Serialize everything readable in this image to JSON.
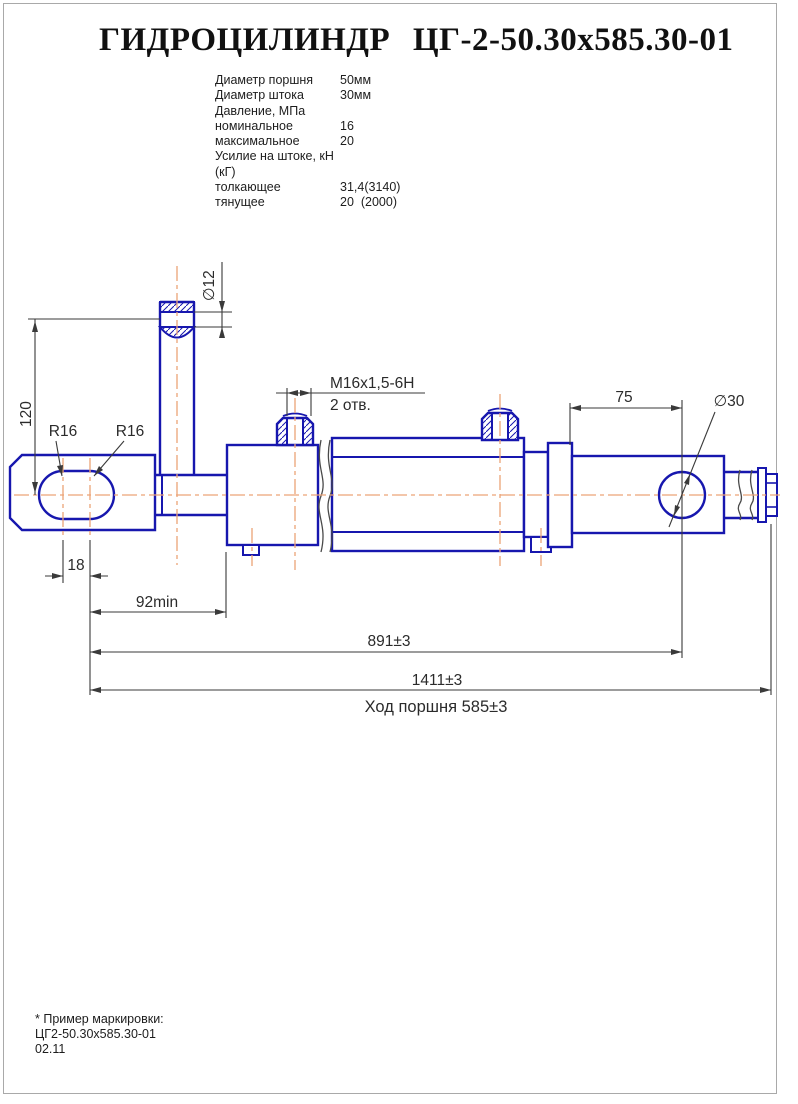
{
  "title": "ГИДРОЦИЛИНДР ЦГ-2-50.30х585.30-01",
  "specs": {
    "rows": [
      {
        "label": "Диаметр поршня",
        "value": "50мм"
      },
      {
        "label": "Диаметр штока",
        "value": "30мм"
      },
      {
        "label": "Давление, МПа",
        "value": ""
      },
      {
        "label": "номинальное",
        "value": "16"
      },
      {
        "label": "максимальное",
        "value": "20"
      },
      {
        "label": "Усилие на штоке, кН (кГ)",
        "value": ""
      },
      {
        "label": "толкающее",
        "value": "31,4(3140)"
      },
      {
        "label": "тянущее",
        "value": "20  (2000)"
      }
    ]
  },
  "drawing": {
    "colors": {
      "outline": "#1717ae",
      "centerline": "#eca377",
      "dimension": "#3a3a3a"
    },
    "labels": {
      "pin_hole_dia": "∅12",
      "pin_height": "120",
      "slot_radius_left": "R16",
      "slot_radius_right": "R16",
      "thread": "M16x1,5-6H",
      "holes_count": "2 отв.",
      "rod_end_offset": "75",
      "eye_hole_dia": "∅30",
      "slot_center_dist": "18",
      "min_clearance": "92min",
      "mount_length": "891±3",
      "overall_length": "1411±3",
      "stroke_note": "Ход поршня 585±3"
    }
  },
  "footer": {
    "line1": "* Пример маркировки:",
    "line2": "ЦГ2-50.30х585.30-01",
    "line3": "02.11"
  }
}
